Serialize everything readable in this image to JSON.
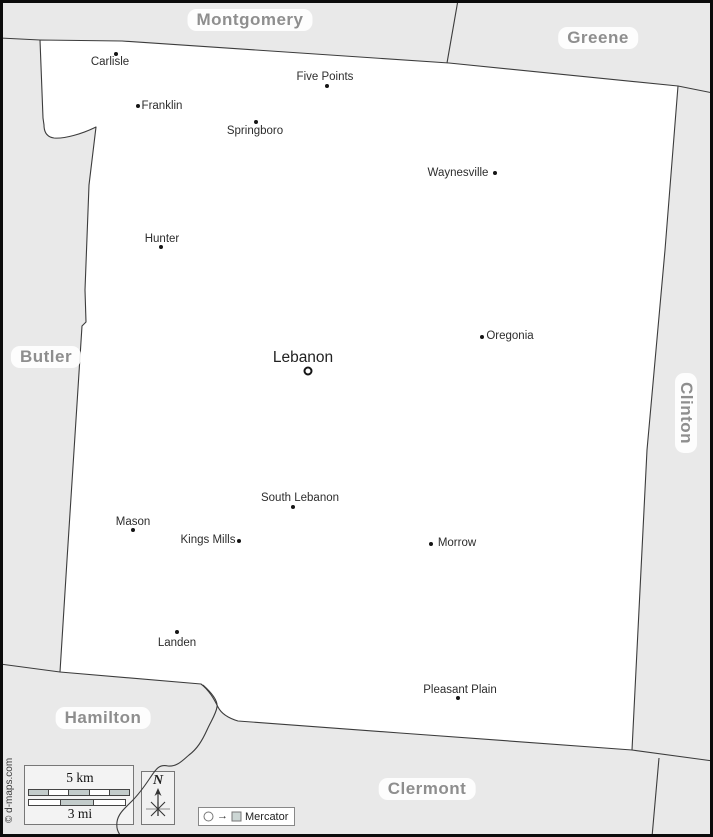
{
  "counties": {
    "montgomery": "Montgomery",
    "greene": "Greene",
    "butler": "Butler",
    "clinton": "Clinton",
    "hamilton": "Hamilton",
    "clermont": "Clermont"
  },
  "cities": [
    {
      "name": "Carlisle"
    },
    {
      "name": "Five Points"
    },
    {
      "name": "Franklin"
    },
    {
      "name": "Springboro"
    },
    {
      "name": "Waynesville"
    },
    {
      "name": "Hunter"
    },
    {
      "name": "Oregonia"
    },
    {
      "name": "Lebanon",
      "county_seat": true
    },
    {
      "name": "South Lebanon"
    },
    {
      "name": "Mason"
    },
    {
      "name": "Kings Mills"
    },
    {
      "name": "Morrow"
    },
    {
      "name": "Landen"
    },
    {
      "name": "Pleasant Plain"
    }
  ],
  "scalebar": {
    "km": "5 km",
    "mi": "3 mi"
  },
  "compass": {
    "north": "N"
  },
  "projection": {
    "arrow": "→",
    "label": "Mercator"
  },
  "credit": "© d-maps.com",
  "colors": {
    "background": "#e9e9e9",
    "county_fill": "#ffffff",
    "boundary": "#3c3c3c",
    "county_label_text": "#8e8e8e",
    "scale_segment": "#c3cccb",
    "marker": "#151515"
  }
}
